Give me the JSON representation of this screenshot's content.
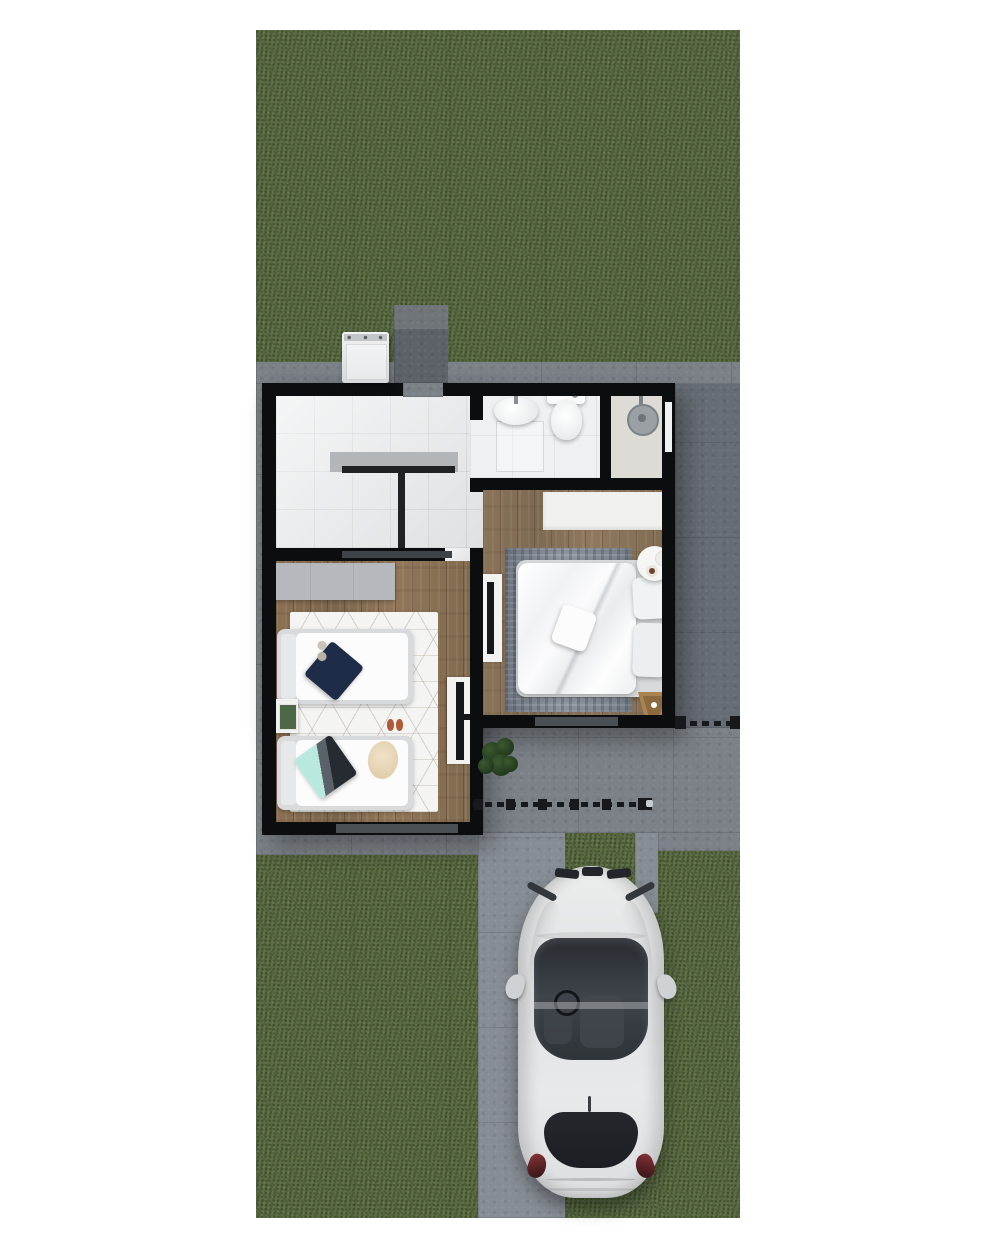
{
  "scene": {
    "title": "top-down-3d-house-floorplan-render",
    "description": "Aerial 3D render of a small single-storey house: tiled kitchen-laundry room, bathroom with shower room, master bedroom, kids bedroom with two single beds, surrounding lawn, concrete walkways, gated driveway and a parked white car.",
    "palette": {
      "background": "#ffffff",
      "grass": "#5a6a42",
      "concrete": "#7b8187",
      "wall": "#0c0d0e",
      "wood_floor": "#8b7355",
      "tile_floor": "#e8eaeb",
      "rug_master": "#88909b",
      "rug_kids": "#f4f4f2",
      "car_body": "#e6e8e9",
      "accent_navy_pillow": "#1f2c47",
      "accent_teal_pillow": "#b9e9de",
      "accent_gold_stool": "#a9844e",
      "plant_green": "#2f4a26"
    },
    "outdoor_areas": [
      "back-lawn",
      "front-lawn-left",
      "front-lawn-right",
      "driveway-lawn-strip",
      "top-concrete-strip",
      "right-side-walkway",
      "entry-court",
      "driveway-track",
      "concrete-utility-pad"
    ],
    "rooms": [
      {
        "name": "kitchen-laundry-room",
        "floor": "white-tile",
        "items": [
          "l-shaped-counter"
        ]
      },
      {
        "name": "bathroom",
        "floor": "white-tile",
        "items": [
          "vanity-sink",
          "faucet",
          "toilet"
        ]
      },
      {
        "name": "shower-room",
        "floor": "light-tile",
        "items": [
          "rain-shower-head",
          "window"
        ]
      },
      {
        "name": "master-bedroom",
        "floor": "wood",
        "items": [
          "wardrobe",
          "double-bed",
          "two-pillows",
          "throw-pillow",
          "gray-area-rug",
          "tv-console",
          "round-side-table",
          "coffee-cup",
          "gold-stool"
        ]
      },
      {
        "name": "kids-bedroom",
        "floor": "wood",
        "items": [
          "dresser",
          "single-bed-top",
          "navy-pillow",
          "single-bed-bottom",
          "teal-pillow",
          "beige-towel",
          "geometric-rug",
          "nightstand",
          "green-book",
          "slippers",
          "tv-console"
        ]
      }
    ]
  },
  "labels": {
    "car": "white car parked on driveway",
    "washer": "top-load washing machine",
    "pad": "concrete utility pad",
    "plant": "potted plant",
    "gate": "driveway gate with posts",
    "fence": "side fence gate",
    "double_bed": "double bed with white duvet",
    "single_bed_1": "single bed with navy pillow",
    "single_bed_2": "single bed with teal pillow",
    "sink": "bathroom sink",
    "toilet": "toilet",
    "shower": "rain shower head",
    "counter": "kitchen counter",
    "rug_master": "gray area rug",
    "rug_kids": "white geometric rug",
    "closet_master": "bedroom wardrobe",
    "dresser_kids": "gray dresser",
    "tv_master": "tv console",
    "tv_kids": "tv console",
    "side_table": "round side table",
    "stool": "gold stool",
    "nightstand": "nightstand"
  }
}
